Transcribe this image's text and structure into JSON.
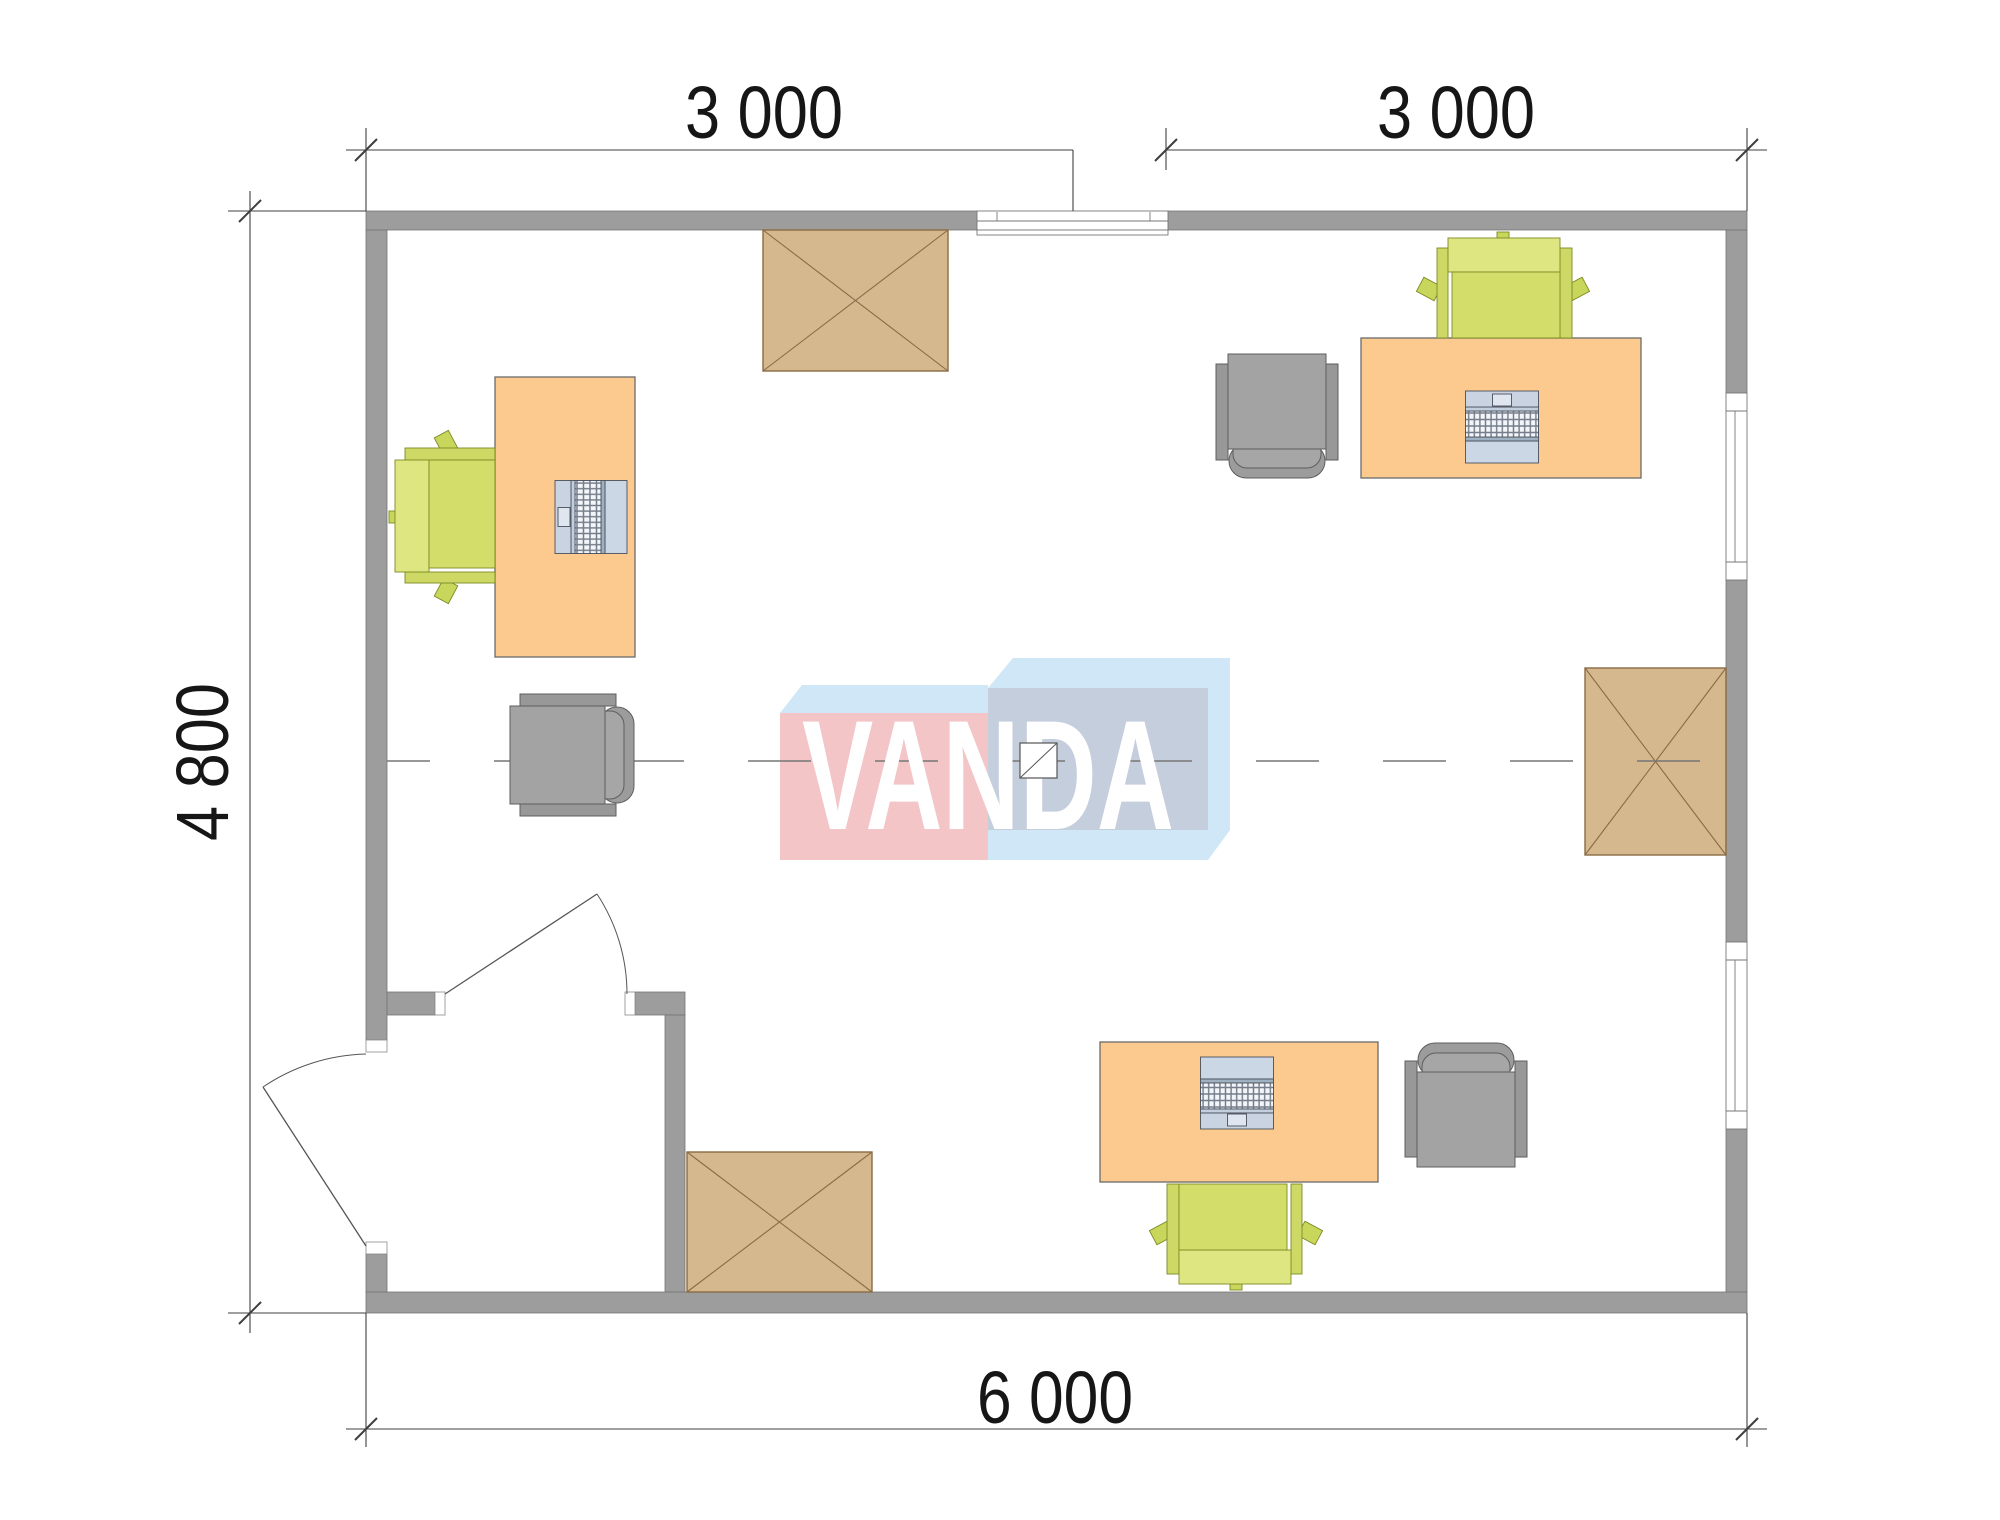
{
  "plan": {
    "title": "office-floor-plan",
    "dimensions": {
      "top_left": "3 000",
      "top_right": "3 000",
      "left": "4 800",
      "bottom": "6 000"
    },
    "logo": {
      "text": "VANDA"
    },
    "colors": {
      "wall": "#9d9d9d",
      "wall_edge": "#757575",
      "desk": "#fcca8f",
      "table": "#d6b88e",
      "table_edge": "#8a6c44",
      "chair_green_seat": "#d2de69",
      "chair_green_back": "#dde681",
      "chair_gray": "#a3a3a3",
      "laptop_body": "#c9d3e1",
      "laptop_screen": "#ccd7e5",
      "logo_pink": "#f3c5c7",
      "logo_blue": "#cfe7f6",
      "logo_panel": "#c5cedd",
      "centerline": "#767676",
      "dimension_line": "#3f3f3f"
    }
  }
}
